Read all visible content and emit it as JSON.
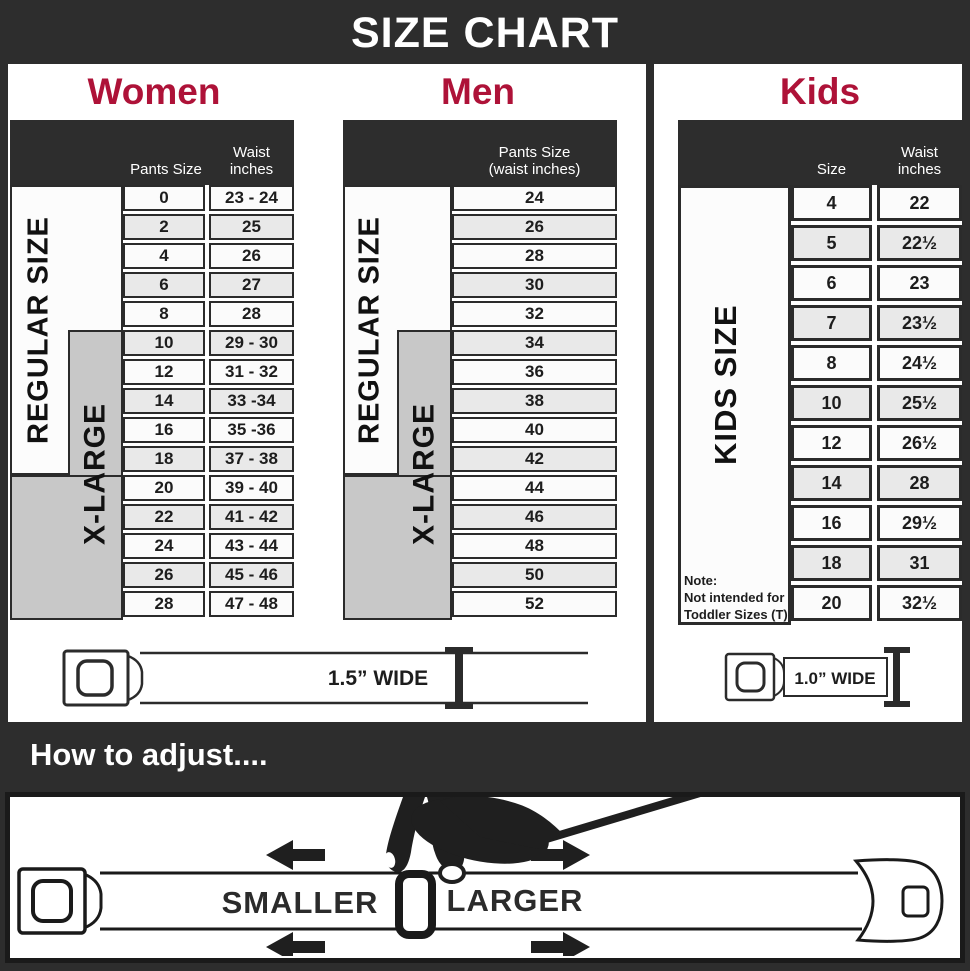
{
  "title": "SIZE CHART",
  "colors": {
    "accent": "#ae1238",
    "charcoal": "#2d2d2d",
    "xlarge_gray": "#c8c8c8"
  },
  "women": {
    "heading": "Women",
    "col_pants": "Pants Size",
    "col_waist_line1": "Waist",
    "col_waist_line2": "inches",
    "regular_label": "REGULAR SIZE",
    "xlarge_label": "X-LARGE",
    "rows": [
      {
        "size": "0",
        "waist": "23 - 24"
      },
      {
        "size": "2",
        "waist": "25"
      },
      {
        "size": "4",
        "waist": "26"
      },
      {
        "size": "6",
        "waist": "27"
      },
      {
        "size": "8",
        "waist": "28"
      },
      {
        "size": "10",
        "waist": "29 - 30"
      },
      {
        "size": "12",
        "waist": "31 - 32"
      },
      {
        "size": "14",
        "waist": "33 -34"
      },
      {
        "size": "16",
        "waist": "35 -36"
      },
      {
        "size": "18",
        "waist": "37 - 38"
      },
      {
        "size": "20",
        "waist": "39 - 40"
      },
      {
        "size": "22",
        "waist": "41 - 42"
      },
      {
        "size": "24",
        "waist": "43 - 44"
      },
      {
        "size": "26",
        "waist": "45 - 46"
      },
      {
        "size": "28",
        "waist": "47 - 48"
      }
    ],
    "belt_label": "1.5” WIDE"
  },
  "men": {
    "heading": "Men",
    "col_line1": "Pants Size",
    "col_line2": "(waist inches)",
    "regular_label": "REGULAR SIZE",
    "xlarge_label": "X-LARGE",
    "rows": [
      "24",
      "26",
      "28",
      "30",
      "32",
      "34",
      "36",
      "38",
      "40",
      "42",
      "44",
      "46",
      "48",
      "50",
      "52"
    ]
  },
  "kids": {
    "heading": "Kids",
    "col_size": "Size",
    "col_waist_line1": "Waist",
    "col_waist_line2": "inches",
    "side_label": "KIDS SIZE",
    "note_title": "Note:",
    "note_line1": "Not intended for",
    "note_line2": "Toddler Sizes (T)",
    "rows": [
      {
        "size": "4",
        "waist": "22"
      },
      {
        "size": "5",
        "waist": "22½"
      },
      {
        "size": "6",
        "waist": "23"
      },
      {
        "size": "7",
        "waist": "23½"
      },
      {
        "size": "8",
        "waist": "24½"
      },
      {
        "size": "10",
        "waist": "25½"
      },
      {
        "size": "12",
        "waist": "26½"
      },
      {
        "size": "14",
        "waist": "28"
      },
      {
        "size": "16",
        "waist": "29½"
      },
      {
        "size": "18",
        "waist": "31"
      },
      {
        "size": "20",
        "waist": "32½"
      }
    ],
    "belt_label": "1.0” WIDE"
  },
  "adjust": {
    "heading": "How to adjust....",
    "smaller_label": "SMALLER",
    "larger_label": "LARGER"
  }
}
